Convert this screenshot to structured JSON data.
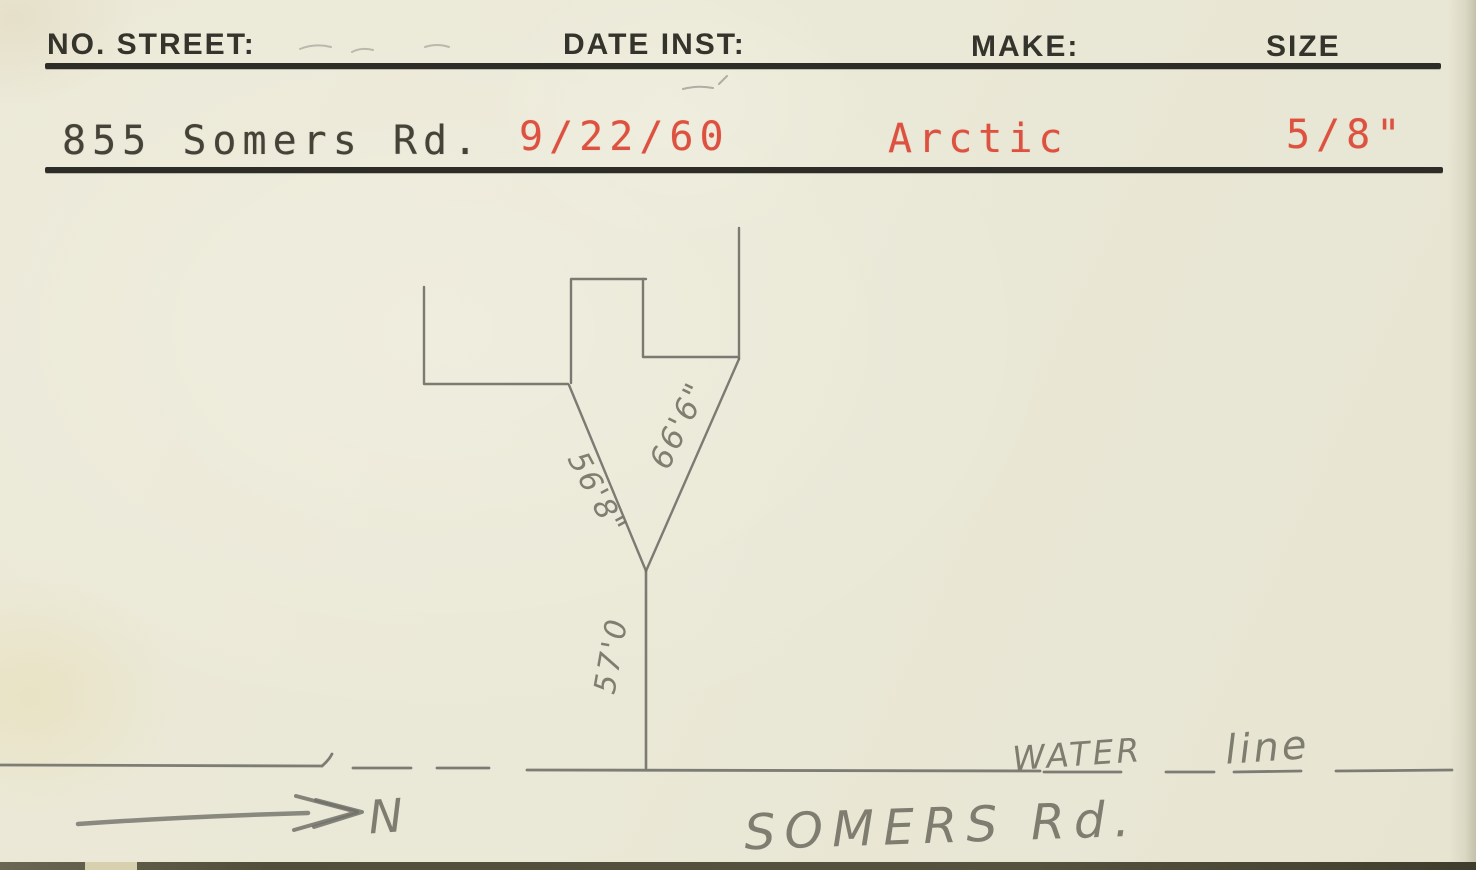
{
  "card": {
    "title": "water service record card",
    "header": {
      "no_street": "NO. STREET:",
      "date_inst": "DATE INST:",
      "make": "MAKE:",
      "size": "SIZE"
    },
    "values": {
      "no_street": "855 Somers Rd.",
      "date_inst": "9/22/60",
      "make": "Arctic",
      "size": "5/8\""
    },
    "sketch": {
      "dim_left": "56'8\"",
      "dim_right": "66'6\"",
      "dim_service": "57'0",
      "north_label": "N",
      "street_name": "SOMERS Rd.",
      "water_word": "WATER",
      "line_word": "line"
    },
    "colors": {
      "card_bg": "#eae8d6",
      "rule_ink": "#2d2c26",
      "header_ink": "#35342c",
      "typed_black": "#454338",
      "typed_red": "#dc5140",
      "pencil_gray": "#71716a",
      "bottom_edge": "#55533e"
    }
  }
}
